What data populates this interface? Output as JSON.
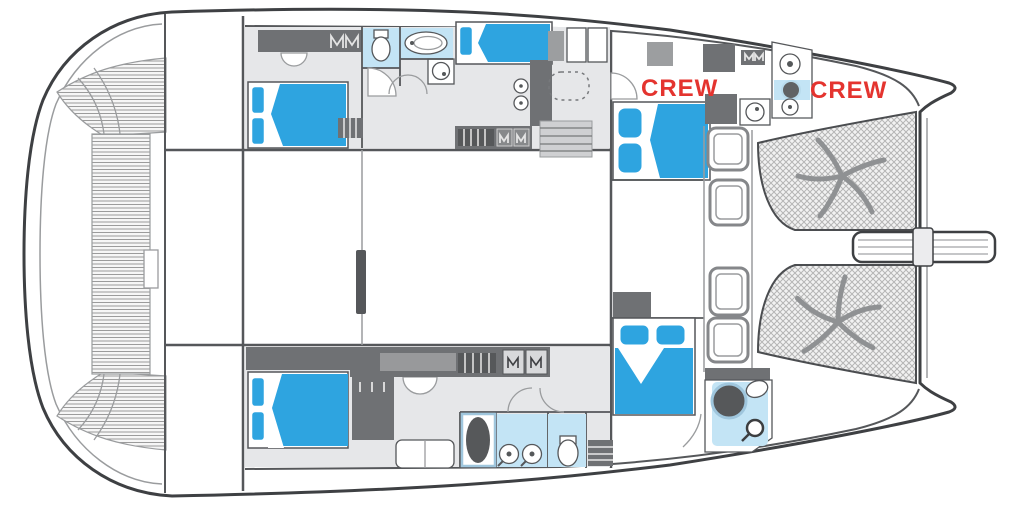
{
  "plan": {
    "type": "catamaran-yacht-deck-plan",
    "labels": {
      "crew_port": "CREW",
      "crew_starboard": "CREW"
    },
    "deck": {
      "hatch_count": 4,
      "trampoline_count": 2,
      "starfish_motif_count": 2,
      "double_berths": 4,
      "single_berths": 1
    },
    "colors": {
      "outline": "#3e4043",
      "wall": "#55575a",
      "wall-light": "#9a9c9e",
      "floor": "#e6e7e9",
      "furniture-dark": "#6f7174",
      "furniture-mid": "#98999b",
      "bed-blue": "#2ea4e0",
      "wet-blue": "#c3e4f5",
      "crew-red": "#e4342f",
      "teak-bg": "#f6f6f6",
      "teak-line": "#9b9b9b",
      "net-bg": "#f2f2f2",
      "net-line": "#b5b5b5",
      "shower-dark": "#56585a"
    }
  }
}
